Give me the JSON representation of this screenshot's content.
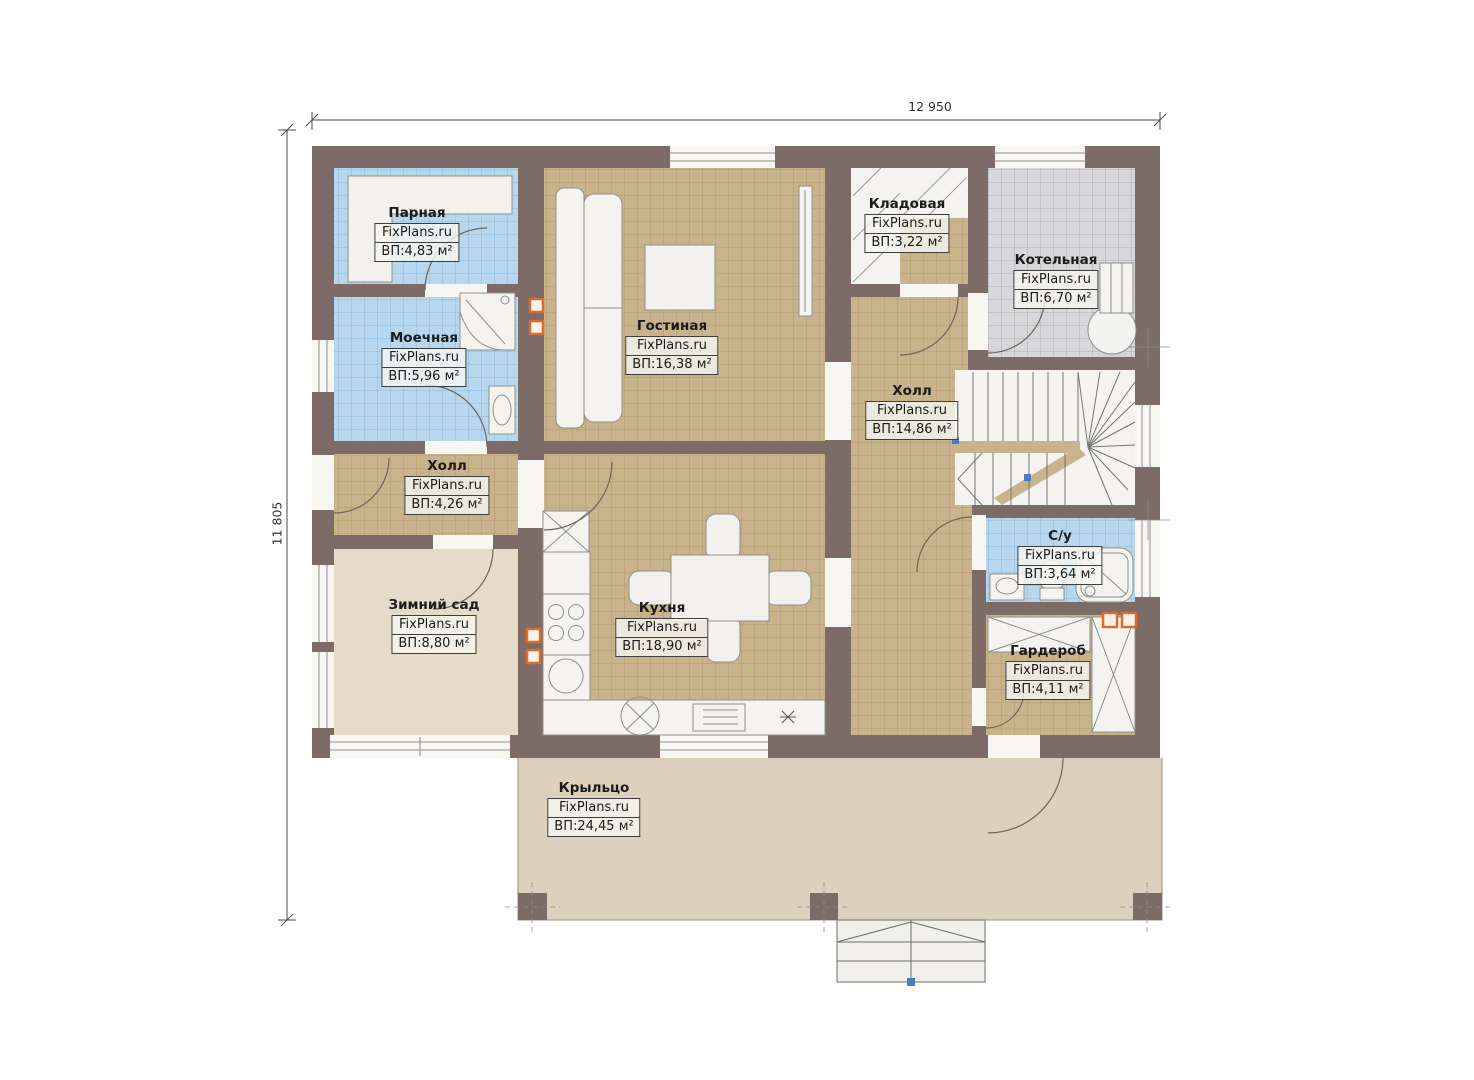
{
  "plan_title": "floor-plan",
  "brand": "FixPlans.ru",
  "dimensions": {
    "width_label": "12 950",
    "height_label": "11 805"
  },
  "rooms": [
    {
      "id": "parnaya",
      "name": "Парная",
      "brand": "FixPlans.ru",
      "area": "ВП:4,83 м²"
    },
    {
      "id": "moechnaya",
      "name": "Моечная",
      "brand": "FixPlans.ru",
      "area": "ВП:5,96 м²"
    },
    {
      "id": "gostinaya",
      "name": "Гостиная",
      "brand": "FixPlans.ru",
      "area": "ВП:16,38 м²"
    },
    {
      "id": "kladovaya",
      "name": "Кладовая",
      "brand": "FixPlans.ru",
      "area": "ВП:3,22 м²"
    },
    {
      "id": "kotelnaya",
      "name": "Котельная",
      "brand": "FixPlans.ru",
      "area": "ВП:6,70 м²"
    },
    {
      "id": "hall-main",
      "name": "Холл",
      "brand": "FixPlans.ru",
      "area": "ВП:14,86 м²"
    },
    {
      "id": "hall-small",
      "name": "Холл",
      "brand": "FixPlans.ru",
      "area": "ВП:4,26 м²"
    },
    {
      "id": "zimniy-sad",
      "name": "Зимний сад",
      "brand": "FixPlans.ru",
      "area": "ВП:8,80 м²"
    },
    {
      "id": "kuhnya",
      "name": "Кухня",
      "brand": "FixPlans.ru",
      "area": "ВП:18,90 м²"
    },
    {
      "id": "su",
      "name": "С/у",
      "brand": "FixPlans.ru",
      "area": "ВП:3,64 м²"
    },
    {
      "id": "garderob",
      "name": "Гардероб",
      "brand": "FixPlans.ru",
      "area": "ВП:4,11 м²"
    },
    {
      "id": "krylco",
      "name": "Крыльцо",
      "brand": "FixPlans.ru",
      "area": "ВП:24,45 м²"
    }
  ],
  "colors": {
    "wall": "#7c6b67",
    "tile_blue": "#b7d7ee",
    "tile_blue_grid": "#86aed0",
    "tile_tan": "#c9b38c",
    "tile_tan_grid": "#ab9066",
    "tile_gray": "#d7d7d9",
    "tile_gray_grid": "#a3a3ab",
    "floor_beige": "#e6dac8",
    "porch": "#ddd1be",
    "room_white": "#f4f3f0",
    "vent_orange": "#d96c2e",
    "dimension_line": "#4a4a4a"
  }
}
